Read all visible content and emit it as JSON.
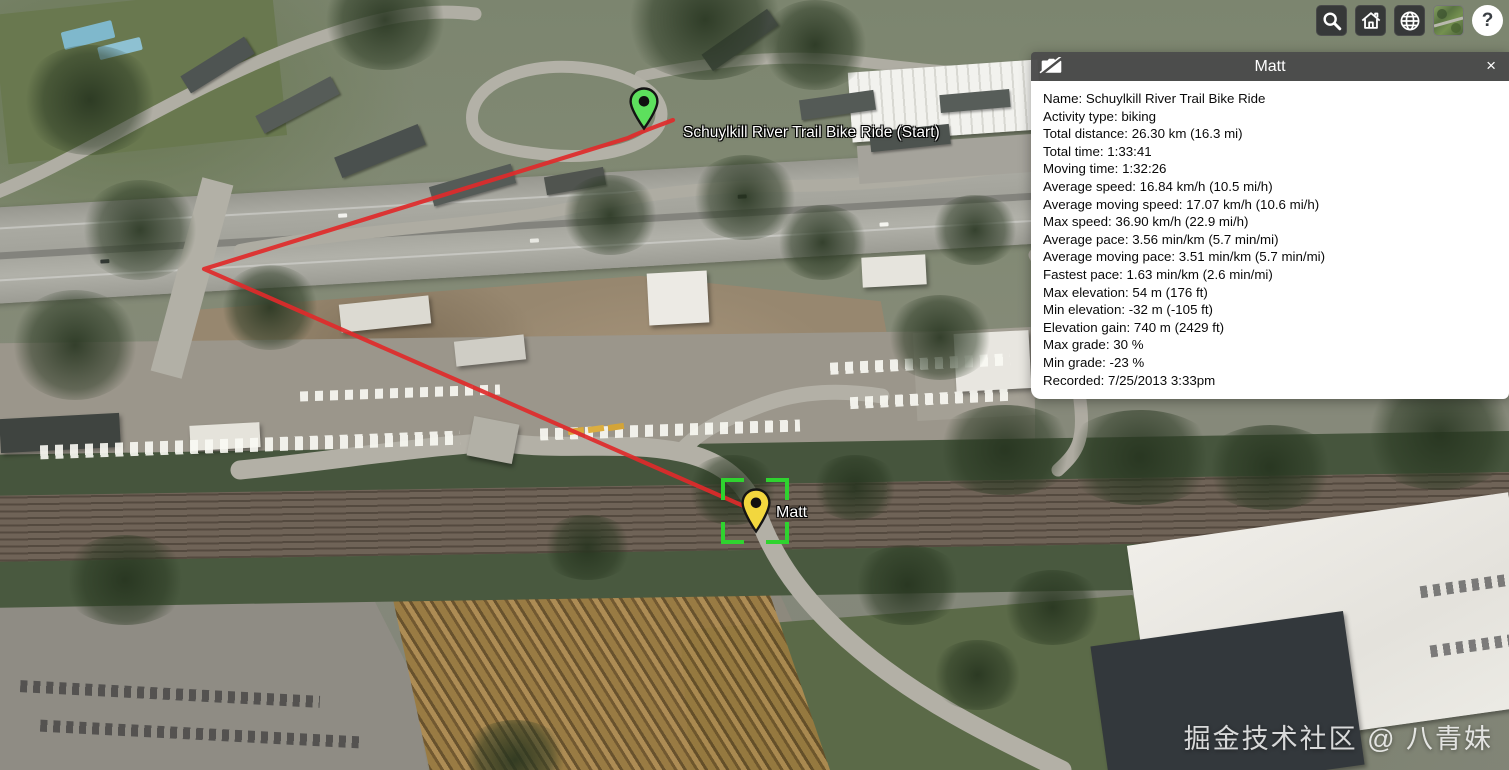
{
  "toolbar": {
    "buttons": [
      {
        "name": "search"
      },
      {
        "name": "home"
      },
      {
        "name": "scene-mode-globe"
      },
      {
        "name": "base-layer-picker"
      },
      {
        "name": "help",
        "glyph": "?"
      }
    ]
  },
  "map": {
    "start_marker_label": "Schuylkill River Trail Bike Ride (Start)",
    "selected_marker_label": "Matt"
  },
  "infobox": {
    "title": "Matt",
    "close_glyph": "×",
    "stats": [
      "Name: Schuylkill River Trail Bike Ride",
      "Activity type: biking",
      "Total distance: 26.30 km (16.3 mi)",
      "Total time: 1:33:41",
      "Moving time: 1:32:26",
      "Average speed: 16.84 km/h (10.5 mi/h)",
      "Average moving speed: 17.07 km/h (10.6 mi/h)",
      "Max speed: 36.90 km/h (22.9 mi/h)",
      "Average pace: 3.56 min/km (5.7 min/mi)",
      "Average moving pace: 3.51 min/km (5.7 min/mi)",
      "Fastest pace: 1.63 min/km (2.6 min/mi)",
      "Max elevation: 54 m (176 ft)",
      "Min elevation: -32 m (-105 ft)",
      "Elevation gain: 740 m (2429 ft)",
      "Max grade: 30 %",
      "Min grade: -23 %",
      "Recorded: 7/25/2013 3:33pm"
    ]
  },
  "watermark": "掘金技术社区 @ 八青妹",
  "colors": {
    "track_line": "#e02a2a",
    "start_pin": "#5de05d",
    "selected_pin": "#f2d73e",
    "selection_bracket": "#2fd32f",
    "panel_header": "#4c4c4c",
    "panel_body": "#ffffff",
    "toolbar_button": "#2c2e31"
  }
}
